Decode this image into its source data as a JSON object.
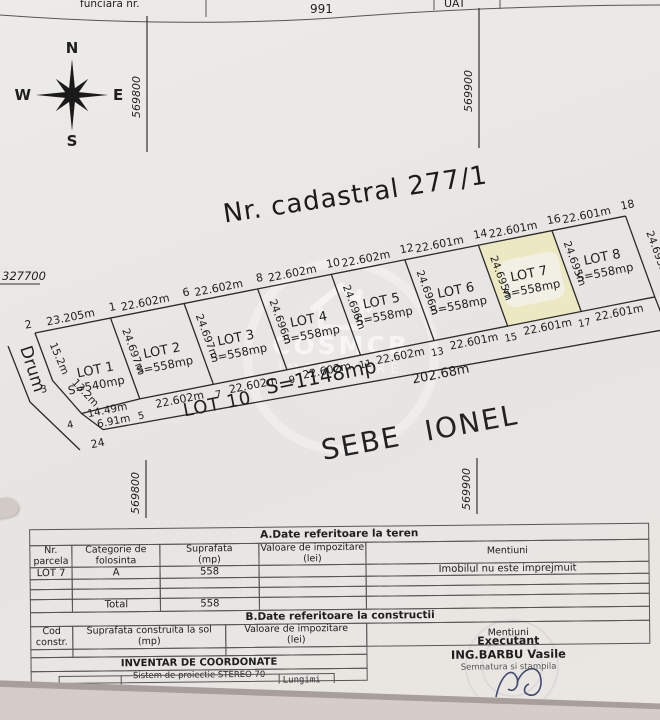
{
  "colors": {
    "paper": "#e9e6e2",
    "scanner_bg": "#cbc2c0",
    "lot7_highlight": "#ece8c2"
  },
  "top_strip": {
    "left_fragment": "funciara nr.",
    "number": "991",
    "uat": "UAT"
  },
  "grid_labels": {
    "left": "569800",
    "right": "569900"
  },
  "compass": {
    "north": "N",
    "south": "S",
    "east": "E",
    "west": "W"
  },
  "plan": {
    "title": "Nr. cadastral 277/1",
    "grid_coord": "327700",
    "road": "Drum",
    "owner": "SEBE IONEL",
    "top_lengths": [
      "23.205m",
      "22.602m",
      "22.602m",
      "22.602m",
      "22.602m",
      "22.601m",
      "22.601m",
      "22.601m"
    ],
    "top_points": [
      "2",
      "1",
      "6",
      "8",
      "10",
      "12",
      "14",
      "16",
      "18"
    ],
    "side_lengths": [
      "24.697m",
      "24.697m",
      "24.696m",
      "24.696m",
      "24.696m",
      "24.695m",
      "24.695m",
      "24.695m"
    ],
    "left_side_lengths": [
      "15.2m",
      "13.2m"
    ],
    "left_points": [
      "3",
      "4"
    ],
    "bottom_lengths": [
      "22.602m",
      "22.602m",
      "22.602m",
      "22.602m",
      "22.601m",
      "22.601m",
      "22.601m"
    ],
    "bottom_points": [
      "5",
      "7",
      "9",
      "11",
      "13",
      "15",
      "17"
    ],
    "bottom_left_lengths": [
      "14.49m",
      "6.91m"
    ],
    "corner_point": "24",
    "lots": [
      {
        "name": "LOT 1",
        "area": "S=540mp"
      },
      {
        "name": "LOT 2",
        "area": "S=558mp"
      },
      {
        "name": "LOT 3",
        "area": "S=558mp"
      },
      {
        "name": "LOT 4",
        "area": "S=558mp"
      },
      {
        "name": "LOT 5",
        "area": "S=558mp"
      },
      {
        "name": "LOT 6",
        "area": "S=558mp"
      },
      {
        "name": "LOT 7",
        "area": "S=558mp"
      },
      {
        "name": "LOT 8",
        "area": "S=558mp"
      }
    ],
    "lot10": {
      "name": "LOT 10",
      "area": "S=1148mp",
      "front": "202.68m"
    }
  },
  "watermark": {
    "line1": "COSMCB",
    "line2": "IMOBILIARE"
  },
  "tables": {
    "a": {
      "title": "A.Date referitoare la teren",
      "headers": [
        [
          "Nr.",
          "parcela"
        ],
        [
          "Categorie de",
          "folosinta"
        ],
        [
          "Suprafata",
          "(mp)"
        ],
        [
          "Valoare de impozitare",
          "(lei)"
        ],
        [
          "Mentiuni",
          ""
        ]
      ],
      "row": {
        "parcela": "LOT 7",
        "categorie": "A",
        "suprafata": "558",
        "valoare": "",
        "mentiuni": "Imobilul nu este imprejmuit"
      },
      "total_label": "Total",
      "total_value": "558"
    },
    "b": {
      "title": "B.Date referitoare la constructii",
      "headers": [
        [
          "Cod",
          "constr."
        ],
        [
          "Suprafata construita la sol",
          "(mp)"
        ],
        [
          "Valoare de impozitare",
          "(lei)"
        ],
        [
          "Mentiuni",
          ""
        ]
      ]
    },
    "footer": {
      "inventar": "INVENTAR DE COORDONATE",
      "sistem": "Sistem de proiectie STEREO 70",
      "lungimi": "Lungimi"
    },
    "executant": {
      "title": "Executant",
      "name": "ING.BARBU Vasile",
      "subtitle": "Semnatura si stampila"
    }
  }
}
